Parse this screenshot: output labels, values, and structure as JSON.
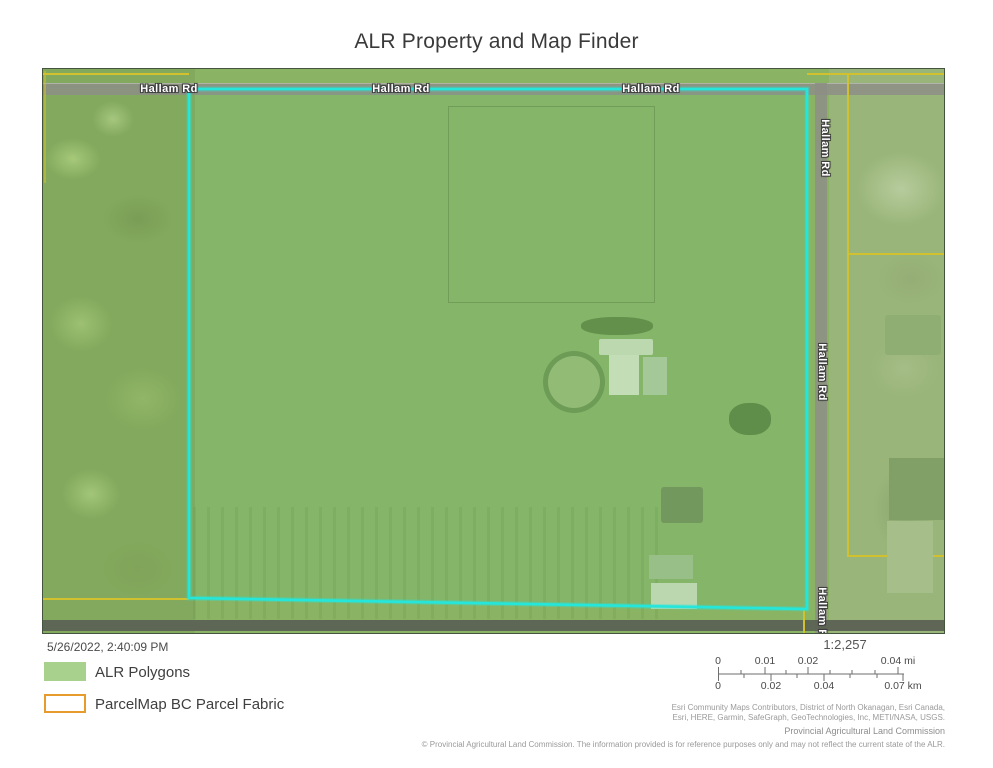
{
  "title": "ALR Property and Map Finder",
  "map": {
    "road_label": "Hallam Rd",
    "colors": {
      "alr_polygon_fill": "#a9d18e",
      "parcel_fabric_outline": "#e79b2d",
      "selected_parcel_highlight": "#25e6da",
      "parcel_line_yellow": "#d2c12f",
      "road_gray": "#8d8e86"
    }
  },
  "footer": {
    "timestamp": "5/26/2022, 2:40:09 PM",
    "legend": [
      {
        "label": "ALR Polygons",
        "swatch": "green-fill"
      },
      {
        "label": "ParcelMap BC Parcel Fabric",
        "swatch": "orange-outline"
      }
    ],
    "scale": {
      "ratio": "1:2,257",
      "mi_labels": [
        "0",
        "0.01",
        "0.02",
        "0.04 mi"
      ],
      "km_labels": [
        "0",
        "0.02",
        "0.04",
        "0.07 km"
      ]
    },
    "attribution_line1": "Esri Community Maps Contributors, District of North Okanagan, Esri Canada,",
    "attribution_line2": "Esri, HERE, Garmin, SafeGraph, GeoTechnologies, Inc, METI/NASA, USGS.",
    "credit": "Provincial Agricultural Land Commission",
    "copyright": "© Provincial Agricultural Land Commission. The information provided is for reference purposes only and may not reflect the current state of the ALR."
  }
}
